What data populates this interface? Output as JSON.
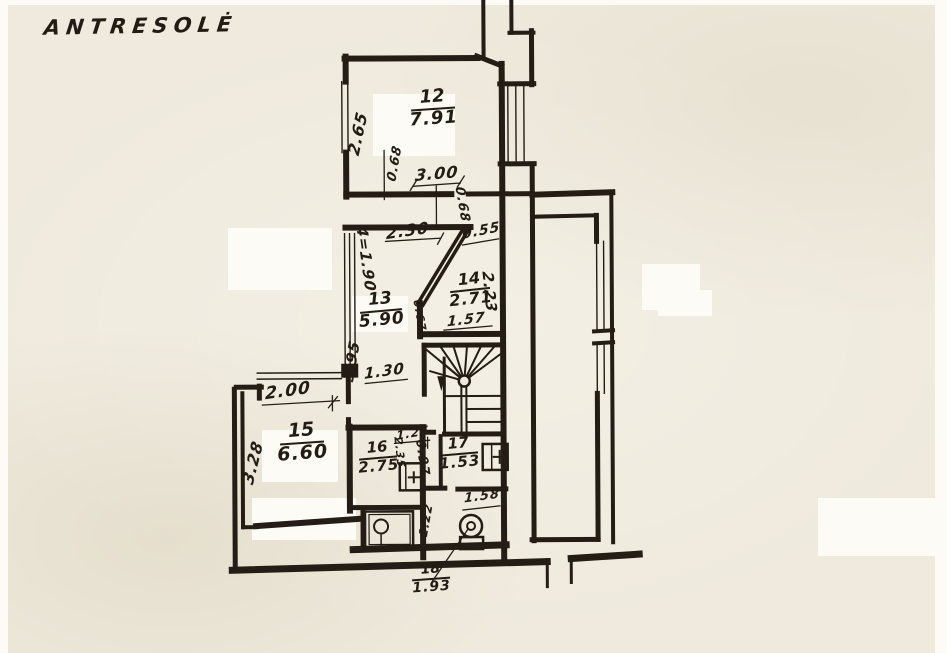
{
  "colors": {
    "paper": "#efeadd",
    "ink": "#221c15",
    "whiteout": "#fcfbf6"
  },
  "title": "ANTRESOLĖ",
  "rooms": {
    "r12": {
      "number": "12",
      "area": "7.91"
    },
    "r13": {
      "number": "13",
      "area": "5.90"
    },
    "r14": {
      "number": "14",
      "area": "2.71"
    },
    "r15": {
      "number": "15",
      "area": "6.60"
    },
    "r16": {
      "number": "16",
      "area": "2.75"
    },
    "r17": {
      "number": "17",
      "area": "1.53"
    },
    "r18": {
      "number": "18",
      "area": "1.93"
    }
  },
  "dims": {
    "r12_left": "2.65",
    "r12_wall_a": "0.68",
    "r12_bottom": "3.00",
    "r12_wall_b": "0.68",
    "corridor_top": "2.30",
    "r14_top": "0.55",
    "height_mark": "4=1.90",
    "r14_right": "2.23",
    "r14_bottom": "1.57",
    "diag_wall": "0.67",
    "r13_left": "3.95",
    "corridor_low": "1.30",
    "r15_top": "2.00",
    "r15_left": "3.28",
    "r16_top": "1.25",
    "r16_right": "2.35",
    "r17_left": "0.97",
    "r18_top": "1.58",
    "r18_left": "1.22"
  }
}
